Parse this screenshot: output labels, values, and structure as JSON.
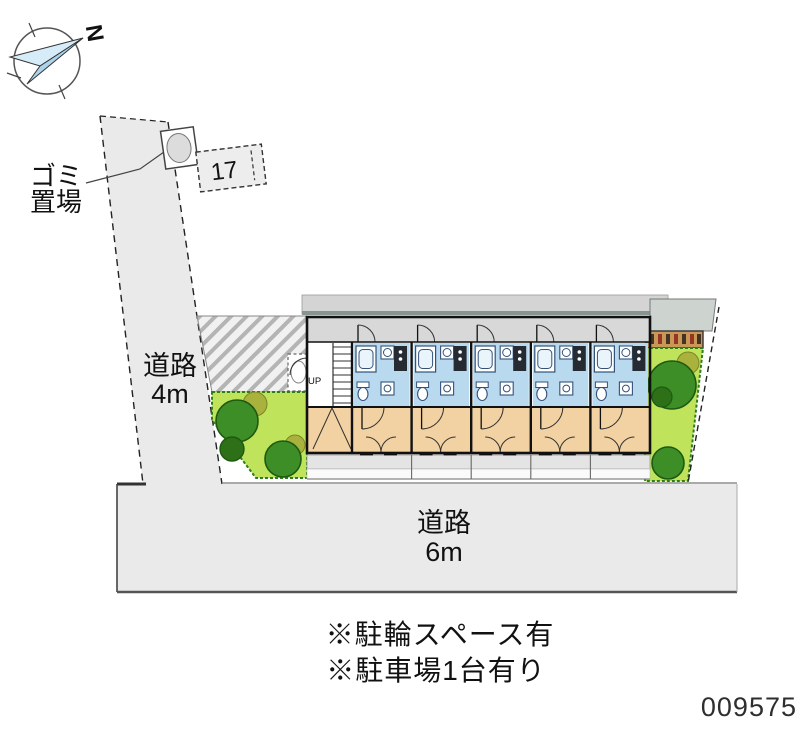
{
  "compass": {
    "label": "N"
  },
  "garbage_area": {
    "line1": "ゴミ",
    "line2": "置場"
  },
  "parking_stall": {
    "number": "17"
  },
  "roads": {
    "west": {
      "name": "道路",
      "width": "4m"
    },
    "south": {
      "name": "道路",
      "width": "6m"
    }
  },
  "building": {
    "stairs_label": "UP",
    "unit_count": 5
  },
  "notes": {
    "bicycle": "※駐輪スペース有",
    "car": "※駐車場1台有り"
  },
  "property_number": "009575",
  "colors": {
    "road_fill": "#eaeaea",
    "corridor_fill": "#d8d8d8",
    "bath_fill": "#b9d9ef",
    "room_fill": "#f2d2a2",
    "garden_fill": "#c0e35c",
    "tree_fill": "#3e8e28",
    "olive_fill": "#a8b23c",
    "roof_fill": "#d4d4d4",
    "bike_rack_fill": "#c89858",
    "compass_arrow_light": "#d6ecf8",
    "compass_arrow_dark": "#abd4ea"
  }
}
